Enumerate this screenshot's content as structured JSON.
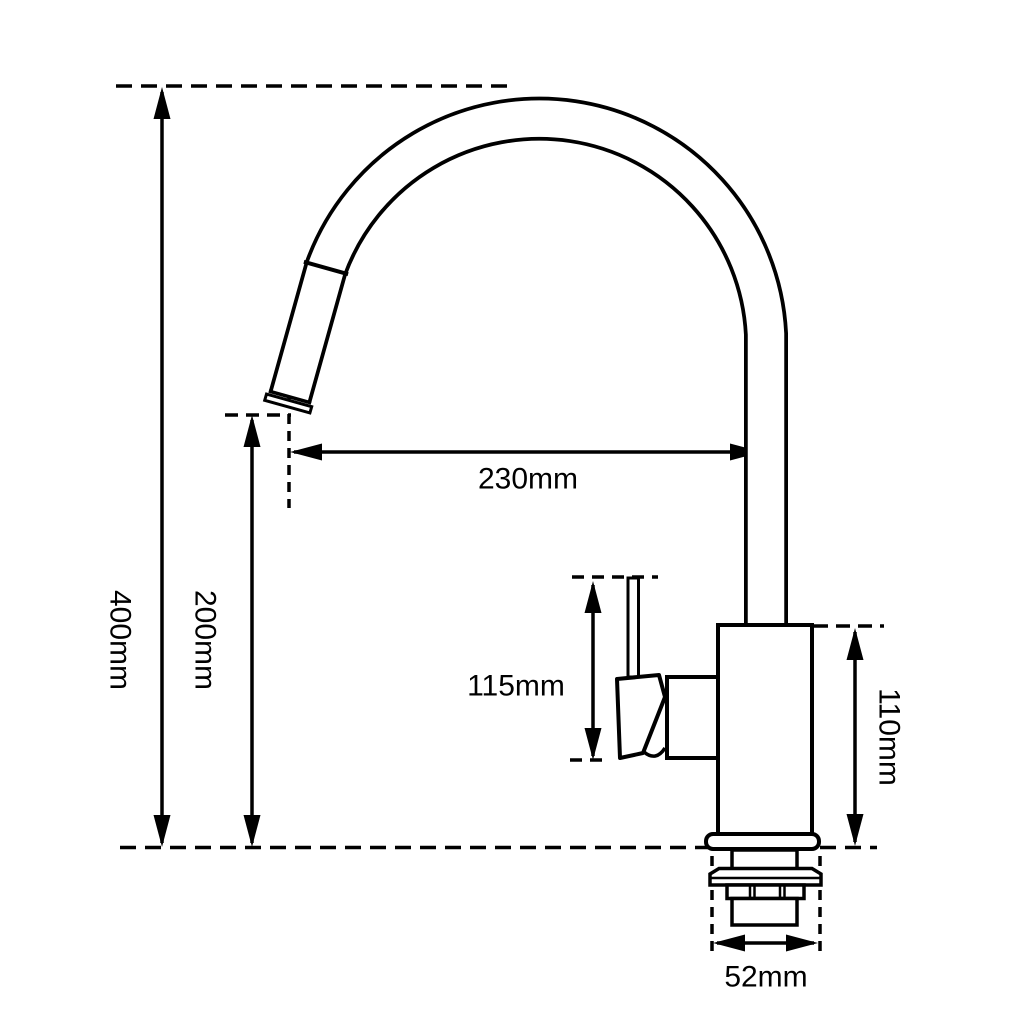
{
  "page": {
    "background": "#ffffff",
    "line_color": "#000000"
  },
  "dims": {
    "overall_height": "400mm",
    "spout_tip_height": "200mm",
    "spout_reach": "230mm",
    "handle_height": "115mm",
    "body_height": "110mm",
    "base_width": "52mm"
  }
}
